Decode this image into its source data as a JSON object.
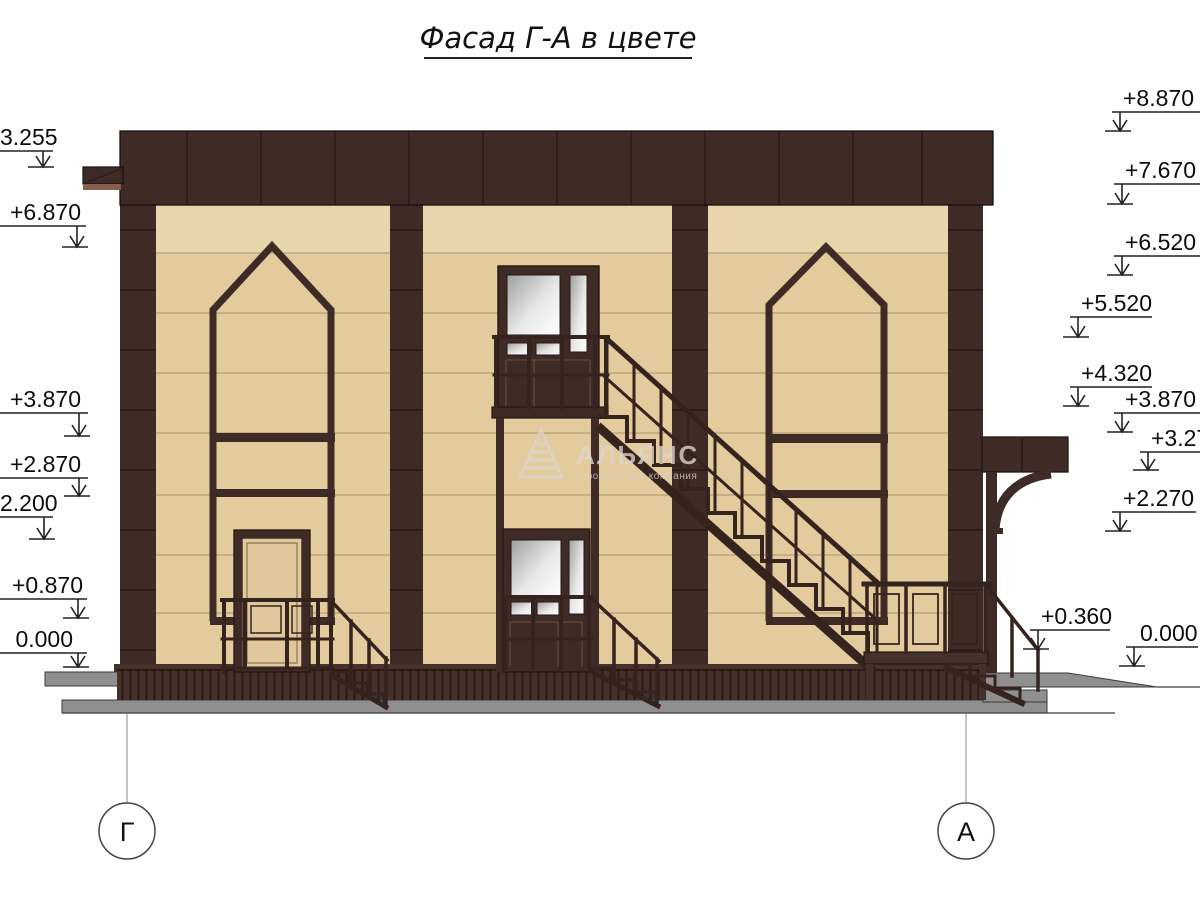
{
  "title": {
    "text": "Фасад Г-А в цвете"
  },
  "watermark": {
    "brand": "АЛЬЯНС",
    "tagline": "строительная компания",
    "icon": "triangle-logo"
  },
  "axis_markers": {
    "left": "Г",
    "right": "А"
  },
  "elevation_marks": {
    "left": [
      "3.255",
      "+6.870",
      "+3.870",
      "+2.870",
      "2.200",
      "+0.870",
      "0.000"
    ],
    "right": [
      "+8.870",
      "+7.670",
      "+6.520",
      "+5.520",
      "+4.320",
      "+3.870",
      "+3.27",
      "+2.270",
      "+0.360",
      "0.000"
    ]
  },
  "palette": {
    "facade_dark": "#3F2B26",
    "facade_dark2": "#46302A",
    "wall_beige": "#E3CB9E",
    "wall_beige_light": "#E9D5AB",
    "joint_line": "#A08A5F",
    "concrete_grey": "#8F8F8F",
    "concrete_grey_light": "#9C9C9C",
    "glass_shade": "#ADADAD",
    "marker_ink": "#222222"
  }
}
